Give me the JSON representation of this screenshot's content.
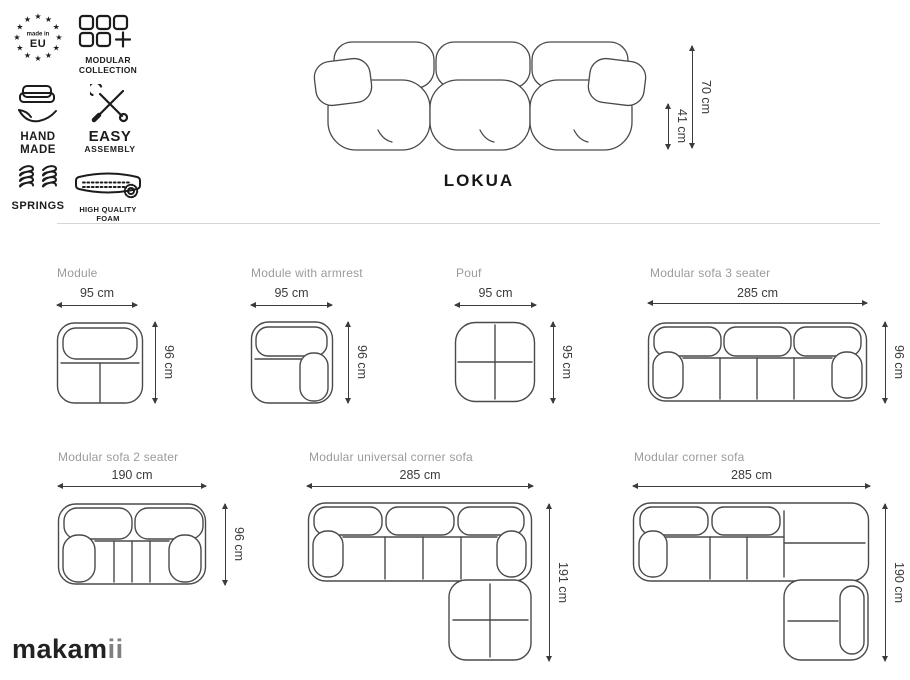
{
  "brand": {
    "logo_main": "makam",
    "logo_accent": "ii"
  },
  "badges": [
    {
      "name": "made-in-eu",
      "line1": "made in",
      "line2": "EU"
    },
    {
      "name": "modular-collection",
      "line1": "MODULAR",
      "line2": "COLLECTION"
    },
    {
      "name": "hand-made",
      "line1": "HAND",
      "line2": "MADE"
    },
    {
      "name": "easy-assembly",
      "line1": "EASY",
      "line2": "ASSEMBLY"
    },
    {
      "name": "springs",
      "line1": "SPRINGS"
    },
    {
      "name": "high-quality-foam",
      "line1": "HIGH QUALITY",
      "line2": "FOAM"
    }
  ],
  "hero": {
    "title": "LOKUA",
    "total_height": "70 cm",
    "seat_height": "41 cm"
  },
  "configurations": [
    {
      "name": "Module",
      "width": "95 cm",
      "depth": "96 cm"
    },
    {
      "name": "Module with armrest",
      "width": "95 cm",
      "depth": "96 cm"
    },
    {
      "name": "Pouf",
      "width": "95 cm",
      "depth": "95 cm"
    },
    {
      "name": "Modular sofa 3 seater",
      "width": "285 cm",
      "depth": "96 cm"
    },
    {
      "name": "Modular sofa 2 seater",
      "width": "190 cm",
      "depth": "96 cm"
    },
    {
      "name": "Modular universal corner sofa",
      "width": "285 cm",
      "depth": "191 cm"
    },
    {
      "name": "Modular corner sofa",
      "width": "285 cm",
      "depth": "190 cm"
    }
  ],
  "colors": {
    "line_art": "#4a4a4a",
    "label_gray": "#9b9b9b",
    "dim_text": "#3b3b3b",
    "divider": "#d6d6d6",
    "ink": "#1c1c1c",
    "logo_accent": "#7f7f7f"
  }
}
